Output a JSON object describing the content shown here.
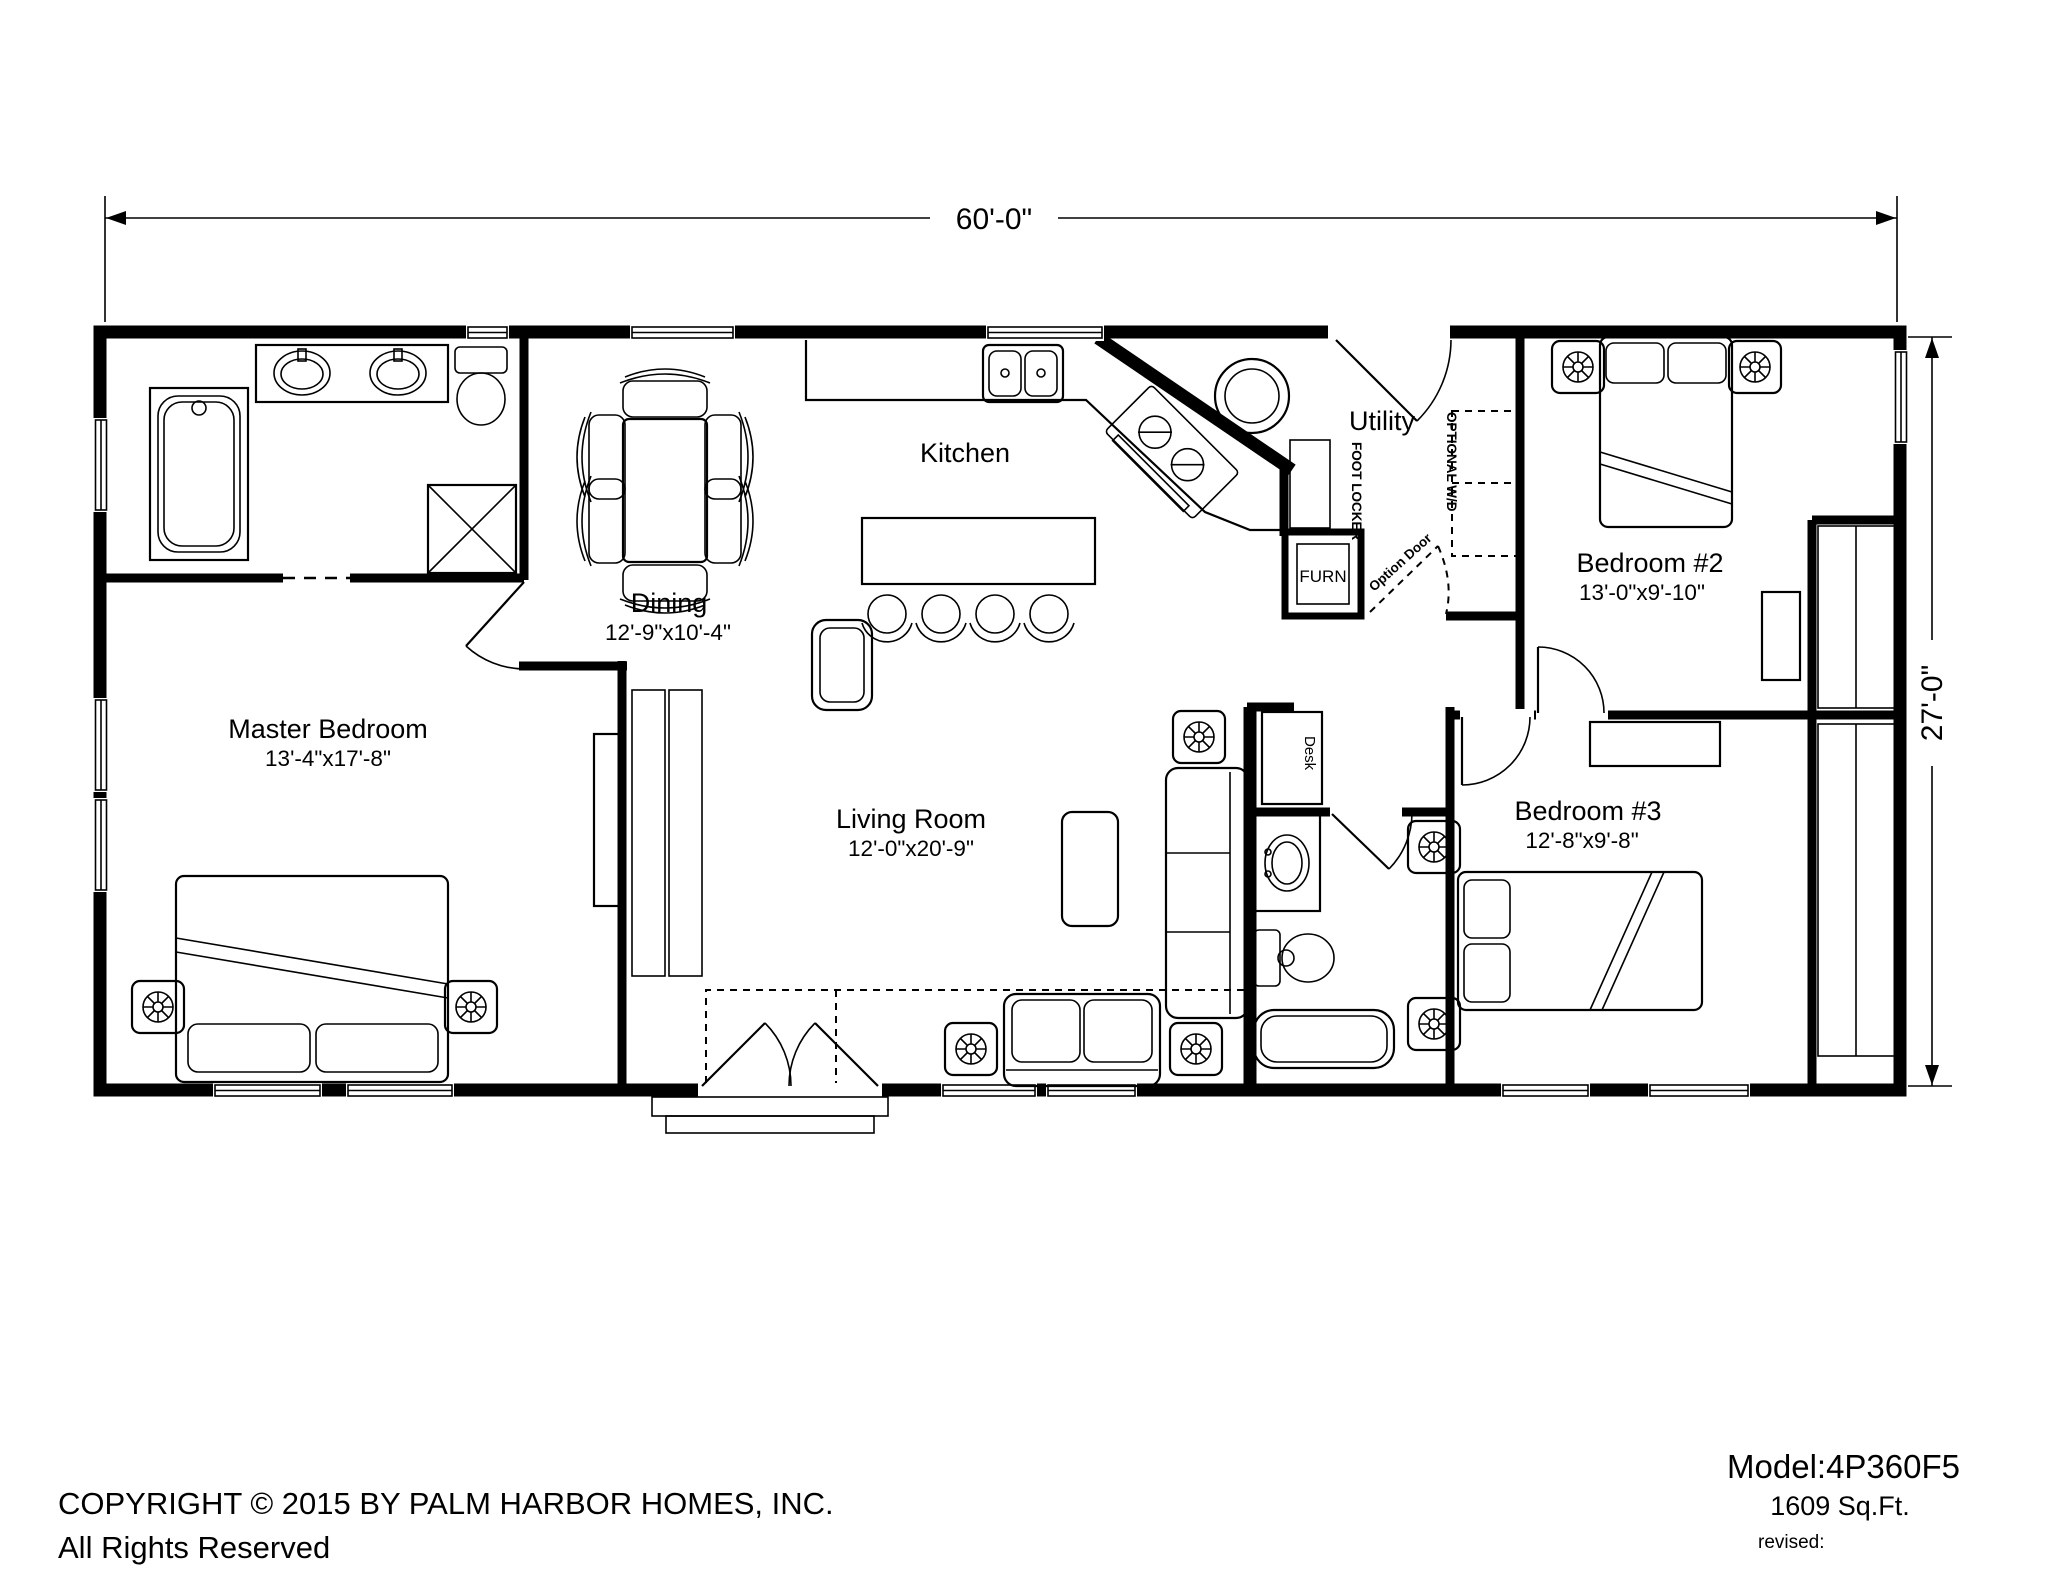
{
  "drawing": {
    "type": "floor-plan",
    "ink_color": "#000000",
    "background_color": "#ffffff"
  },
  "dimensions": {
    "overall_width": "60'-0\"",
    "overall_depth": "27'-0\""
  },
  "rooms": {
    "master_bedroom": {
      "name": "Master Bedroom",
      "size": "13'-4\"x17'-8\""
    },
    "dining": {
      "name": "Dining",
      "size": "12'-9\"x10'-4\""
    },
    "kitchen": {
      "name": "Kitchen"
    },
    "living_room": {
      "name": "Living Room",
      "size": "12'-0\"x20'-9\""
    },
    "utility": {
      "name": "Utility"
    },
    "bedroom_2": {
      "name": "Bedroom #2",
      "size": "13'-0\"x9'-10\""
    },
    "bedroom_3": {
      "name": "Bedroom #3",
      "size": "12'-8\"x9'-8\""
    }
  },
  "annotations": {
    "furnace": "FURN",
    "foot_locker": "FOOT LOCKER",
    "optional_wd": "OPTIONAL W/D",
    "option_door": "Option Door",
    "desk": "Desk"
  },
  "title_block": {
    "model": "Model:4P360F5",
    "area": "1609 Sq.Ft.",
    "revised": "revised:"
  },
  "footer": {
    "copyright": "COPYRIGHT © 2015 BY PALM HARBOR HOMES, INC.",
    "rights": "All Rights Reserved"
  }
}
